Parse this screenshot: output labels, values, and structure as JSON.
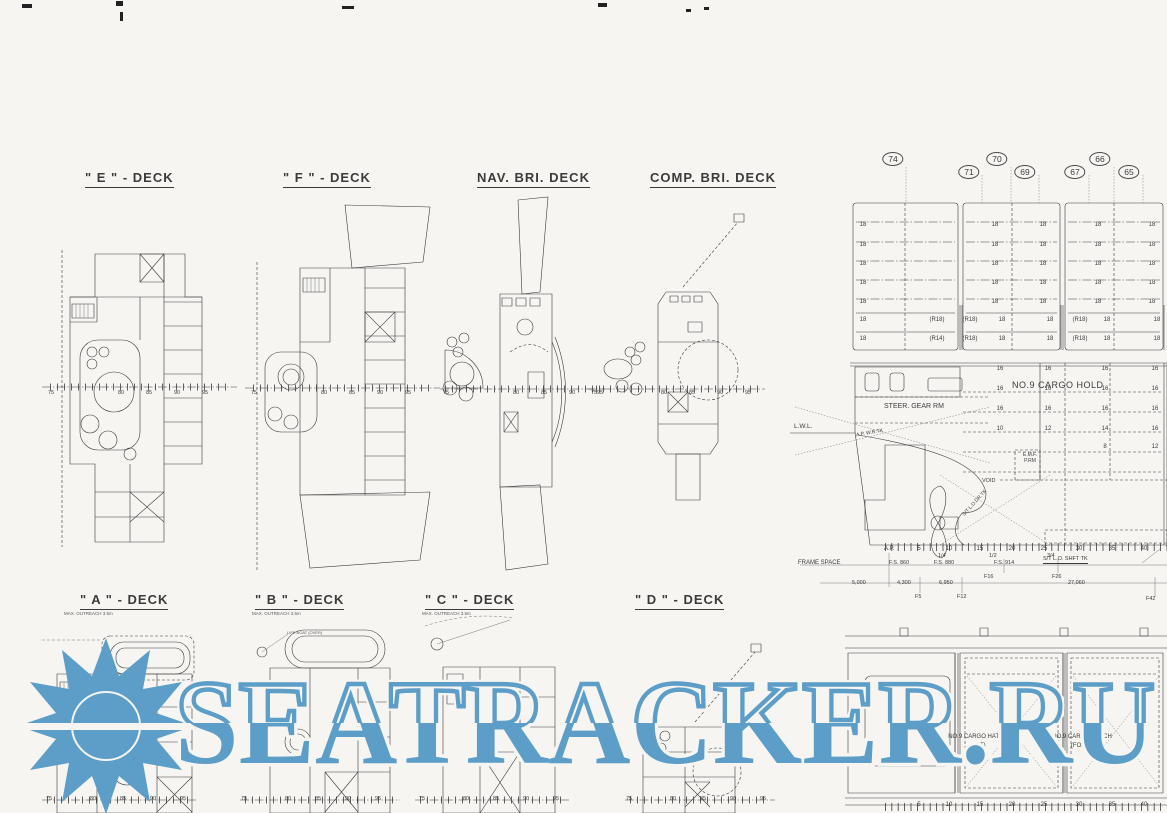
{
  "page": {
    "bg": "#f6f5f2",
    "ink": "#3b3b3b",
    "accent": "#5C9EC7"
  },
  "watermark": {
    "text": "SEATRACKER.RU"
  },
  "top_decks": [
    {
      "title": "\" E \" - DECK"
    },
    {
      "title": "\" F \" - DECK"
    },
    {
      "title": "NAV. BRI. DECK"
    },
    {
      "title": "COMP. BRI. DECK"
    }
  ],
  "bottom_decks": [
    {
      "title": "\" A \" - DECK",
      "note": "MAX. OUTREACH 3.5m"
    },
    {
      "title": "\" B \" - DECK",
      "note": "MAX. OUTREACH 3.5m"
    },
    {
      "title": "\" C \" - DECK",
      "note": "MAX. OUTREACH 3.5m"
    },
    {
      "title": "\" D \" - DECK",
      "note": ""
    }
  ],
  "boat_label": "LIFE BOAT (OVER)",
  "frame_bubbles": [
    "74",
    "71",
    "70",
    "69",
    "67",
    "66",
    "65"
  ],
  "centerline_labels": [
    "75",
    "80",
    "85",
    "90",
    "95"
  ],
  "profile": {
    "tier_rows": [
      [
        "18",
        "18",
        "18",
        "18",
        "18"
      ],
      [
        "18",
        "18",
        "18",
        "18",
        "18"
      ],
      [
        "18",
        "18",
        "18",
        "18",
        "18"
      ],
      [
        "18",
        "18",
        "18",
        "18",
        "18"
      ],
      [
        "18",
        "18",
        "18",
        "18",
        "18"
      ]
    ],
    "r_row1": [
      "18",
      "(R18)",
      "(R18)",
      "18",
      "18",
      "(R18)",
      "18",
      "18"
    ],
    "r_row2": [
      "18",
      "(R14)",
      "(R18)",
      "18",
      "18",
      "(R18)",
      "18",
      "18"
    ],
    "hold_rows": [
      [
        "16",
        "16",
        "16",
        "16"
      ],
      [
        "16",
        "16",
        "16",
        "16"
      ],
      [
        "16",
        "16",
        "16",
        "16"
      ],
      [
        "10",
        "12",
        "14",
        "16"
      ],
      [
        "8",
        "12"
      ]
    ],
    "labels": {
      "cargo_hold": "NO.9 CARGO HOLD",
      "steer_gear": "STEER. GEAR RM",
      "emf": "E.M.F. P.RM",
      "void": "VOID",
      "lwl": "L.W.L.",
      "aft_peak": "A.P. W.B.TK",
      "st_lo": "S/T L.O.DR.TK"
    }
  },
  "frame_table": {
    "label": "FRAME SPACE",
    "ap": "A.P.",
    "ticks": [
      "5",
      "10",
      "15",
      "20",
      "25",
      "30",
      "35",
      "40"
    ],
    "quarters": [
      "1/4",
      "1/2",
      "3/4"
    ],
    "fs": [
      "F.S. 860",
      "F.S. 880",
      "F.S. 914"
    ],
    "shaft_tank": "S/T L.O. SHFT TK",
    "dims": [
      "5,000",
      "4,300",
      "6,950",
      "27,060"
    ],
    "refs": [
      "F5",
      "F12",
      "F16",
      "F26",
      "F42"
    ]
  },
  "hatch": {
    "aft": "NO.9 CARGO HATCH",
    "aft_sub": "(AFT)",
    "ford": "NO.9 CARGO HATCH",
    "ford_sub": "(FOR'D)"
  }
}
